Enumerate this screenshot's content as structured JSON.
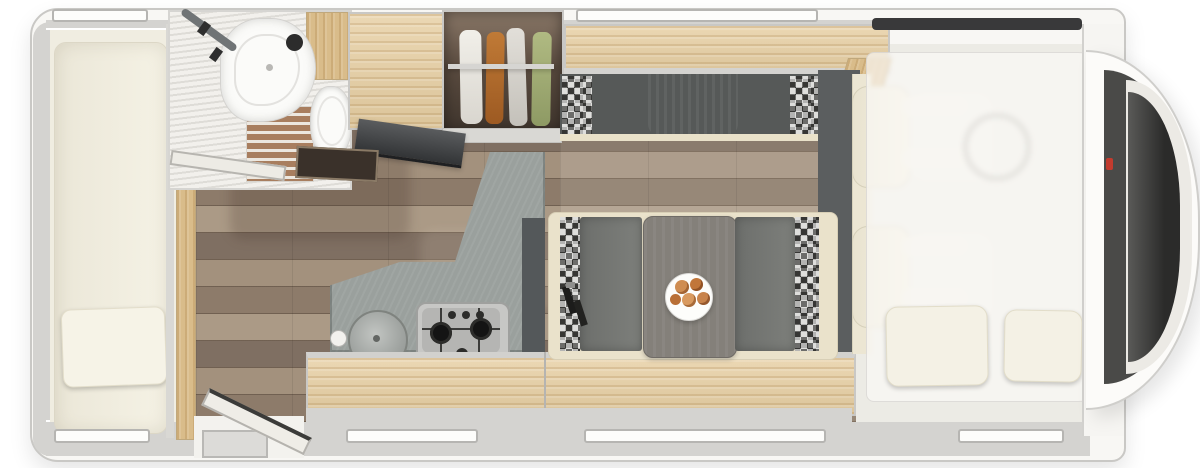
{
  "palette": {
    "body": "#f8f7f4",
    "outline": "#c9c8c5",
    "wall": "#d4d3d0",
    "white": "#fdfdfb",
    "cream": "#f0ede1",
    "cream-dark": "#eae2cb",
    "wood": "#e7cfa3",
    "wood-deep": "#d9bc8a",
    "wardrobe-dark": "#463b31",
    "floor-base": "#94826f",
    "floor-light": "#a4937f",
    "slate": "#9aa09d",
    "slate-dark": "#54585a",
    "bench": "#717370",
    "bench-back": "#8d9492",
    "mat": "#5b5e5f",
    "check-dark": "#4e4e4c",
    "check-light": "#c6c6c4",
    "glass": "#2b2b2a",
    "toilet-white": "#fbfbf9",
    "red": "#c23b2e",
    "food": "#c8834b",
    "belt": "#1c1c1b"
  },
  "scene": {
    "type": "motorhome-floorplan-top-view",
    "orientation": "cab-at-right, rear-at-left",
    "zones": [
      {
        "name": "rear-bedroom",
        "items": [
          "longitudinal-bed",
          "pillow",
          "bottom-window",
          "top-window"
        ]
      },
      {
        "name": "bathroom",
        "items": [
          "pleated-shower-wall",
          "wooden-slat-shower-floor",
          "washbasin",
          "black-faucet",
          "toilet",
          "grab-rail",
          "open-bathroom-door"
        ]
      },
      {
        "name": "storage-wall",
        "items": [
          "wood-cabinet",
          "wardrobe-with-rail",
          "hanging-clothes-white",
          "hanging-clothes-orange",
          "hanging-clothes-gray",
          "hanging-clothes-green",
          "drop-flap-panel",
          "floor-hatch"
        ]
      },
      {
        "name": "kitchen",
        "items": [
          "l-shaped-slate-worktop",
          "round-sink",
          "three-burner-gas-hob",
          "tall-dark-unit",
          "wood-sideboard",
          "window"
        ]
      },
      {
        "name": "dinette",
        "items": [
          "facing-bench-seats",
          "checkered-backrests",
          "center-table",
          "plate-of-food",
          "seat-belts"
        ]
      },
      {
        "name": "front-lounge",
        "items": [
          "overhead-locker",
          "bench-sofa",
          "checkered-end-cushions",
          "gray-backrest",
          "dark-floor-mat"
        ]
      },
      {
        "name": "cab",
        "items": [
          "driver-swivel-seat",
          "passenger-swivel-seat",
          "steering-wheel",
          "translucent-overcab-bed",
          "pillow-left",
          "pillow-right",
          "windshield",
          "red-marker"
        ]
      },
      {
        "name": "entry",
        "items": [
          "door-opening",
          "entry-step",
          "open-entry-door"
        ]
      }
    ],
    "windows_top_x": [
      52,
      576
    ],
    "windows_bottom_x": [
      54,
      346,
      584,
      958
    ]
  }
}
